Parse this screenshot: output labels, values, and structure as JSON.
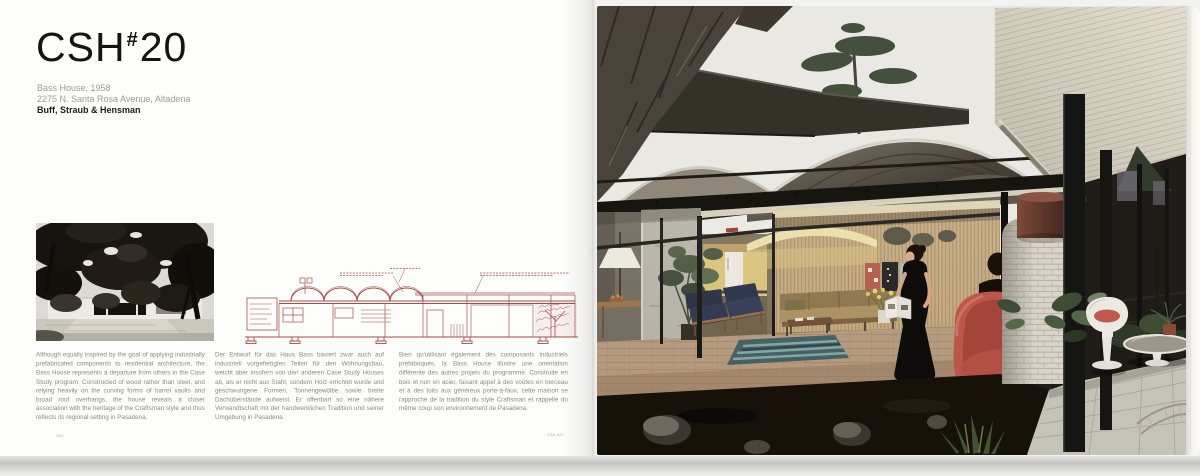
{
  "title": {
    "prefix": "CSH",
    "hash": "#",
    "number": "20"
  },
  "meta": {
    "line1": "Bass House, 1958",
    "line2": "2275 N. Santa Rosa Avenue, Altadena",
    "architects": "Buff, Straub & Hensman"
  },
  "body": {
    "en": "Although equally inspired by the goal of applying industrially prefabricated components to residential architecture, the Bass House represents a departure from others in the Case Study program. Constructed of wood rather than steel, and relying heavily on the curving forms of barrel vaults and broad roof overhangs, the house reveals a closer association with the heritage of the Craftsman style and thus reflects its regional setting in Pasadena.",
    "de": "Der Entwurf für das Haus Bass basiert zwar auch auf industriell vorgefertigten Teilen für den Wohnungsbau, weicht aber insofern von den anderen Case Study Houses ab, als er nicht aus Stahl, sondern Holz errichtet wurde und geschwungene Formen, Tonnengewölbe sowie breite Dachüberstände aufweist. Er offenbart so eine nähere Verwandtschaft mit der handwerklichen Tradition und seiner Umgebung in Pasadena.",
    "fr": "Bien qu'utilisant également des composants industriels préfabriqués, la Bass House illustre une orientation différente des autres projets du programme. Construite en bois et non en acier, faisant appel à des voûtes en berceau et à des toits aux généreux porte-à-faux, cette maison se rapproche de la tradition du style Craftsman et rappelle du même coup son environnement de Pasadena."
  },
  "footer": {
    "page_number": "134",
    "running_title": "CSH #20"
  },
  "colors": {
    "drawing_ink": "#9d3f38",
    "title_ink": "#141414",
    "meta_gray": "#9c9c9a",
    "page_white": "#fdfdfc",
    "womb_chair_red": "#bc564a"
  }
}
